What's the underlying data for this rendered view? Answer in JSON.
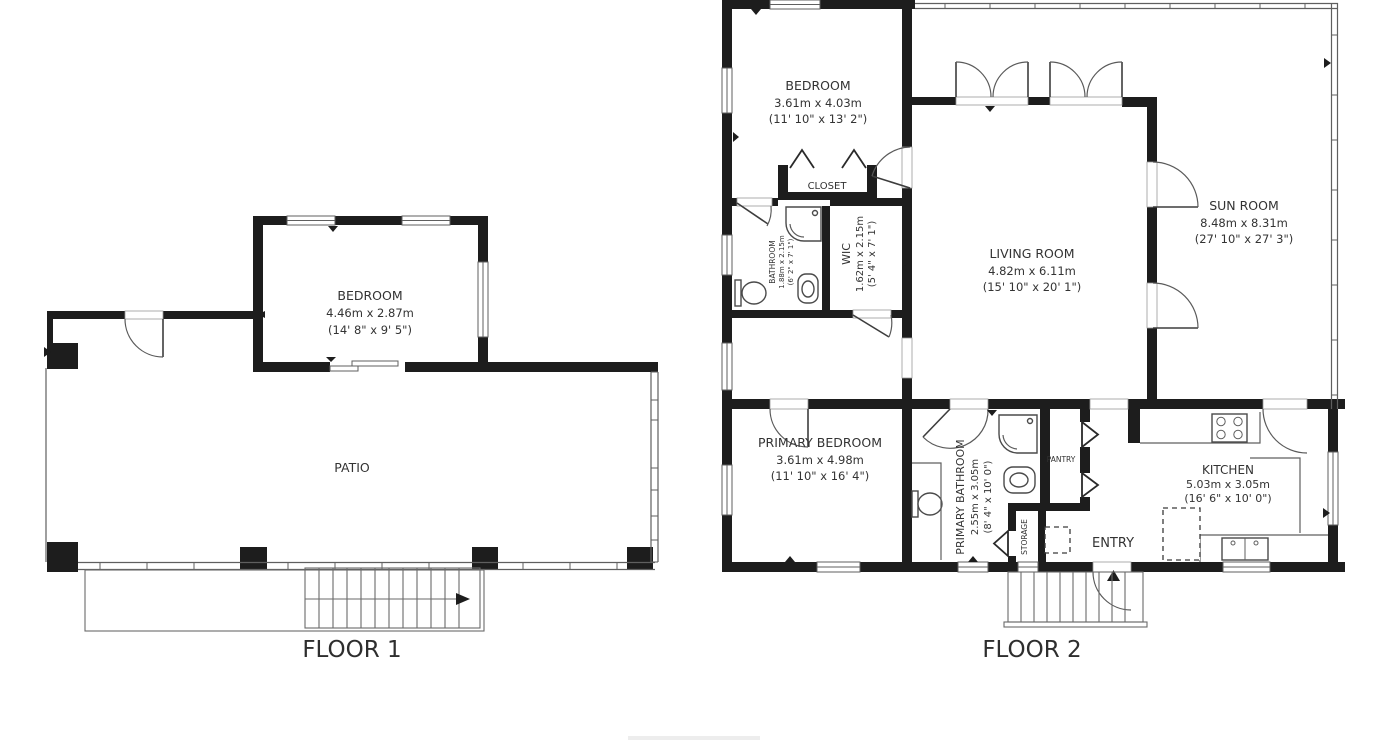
{
  "meta": {
    "background": "#ffffff",
    "wall_color": "#1d1d1d",
    "thin_line_color": "#5f5f5f",
    "text_color": "#333333"
  },
  "floor1": {
    "title": "FLOOR 1",
    "rooms": {
      "bedroom": {
        "name": "BEDROOM",
        "metric": "4.46m x 2.87m",
        "imperial": "(14' 8\" x 9' 5\")"
      },
      "patio": {
        "name": "PATIO"
      }
    }
  },
  "floor2": {
    "title": "FLOOR 2",
    "rooms": {
      "bedroom": {
        "name": "BEDROOM",
        "metric": "3.61m x 4.03m",
        "imperial": "(11' 10\" x 13' 2\")"
      },
      "closet": {
        "name": "CLOSET"
      },
      "bathroom": {
        "name": "BATHROOM",
        "metric": "1.88m x 2.15m",
        "imperial": "(6' 2\" x 7' 1\")"
      },
      "wic": {
        "name": "WIC",
        "metric": "1.62m x 2.15m",
        "imperial": "(5' 4\" x 7' 1\")"
      },
      "living_room": {
        "name": "LIVING ROOM",
        "metric": "4.82m x 6.11m",
        "imperial": "(15' 10\" x 20' 1\")"
      },
      "sun_room": {
        "name": "SUN ROOM",
        "metric": "8.48m x 8.31m",
        "imperial": "(27' 10\" x 27' 3\")"
      },
      "primary_bedroom": {
        "name": "PRIMARY BEDROOM",
        "metric": "3.61m x 4.98m",
        "imperial": "(11' 10\" x 16' 4\")"
      },
      "primary_bathroom": {
        "name": "PRIMARY BATHROOM",
        "metric": "2.55m x 3.05m",
        "imperial": "(8' 4\" x 10' 0\")"
      },
      "pantry": {
        "name": "PANTRY"
      },
      "storage": {
        "name": "STORAGE"
      },
      "kitchen": {
        "name": "KITCHEN",
        "metric": "5.03m x 3.05m",
        "imperial": "(16' 6\" x 10' 0\")"
      },
      "entry": {
        "name": "ENTRY"
      }
    }
  }
}
